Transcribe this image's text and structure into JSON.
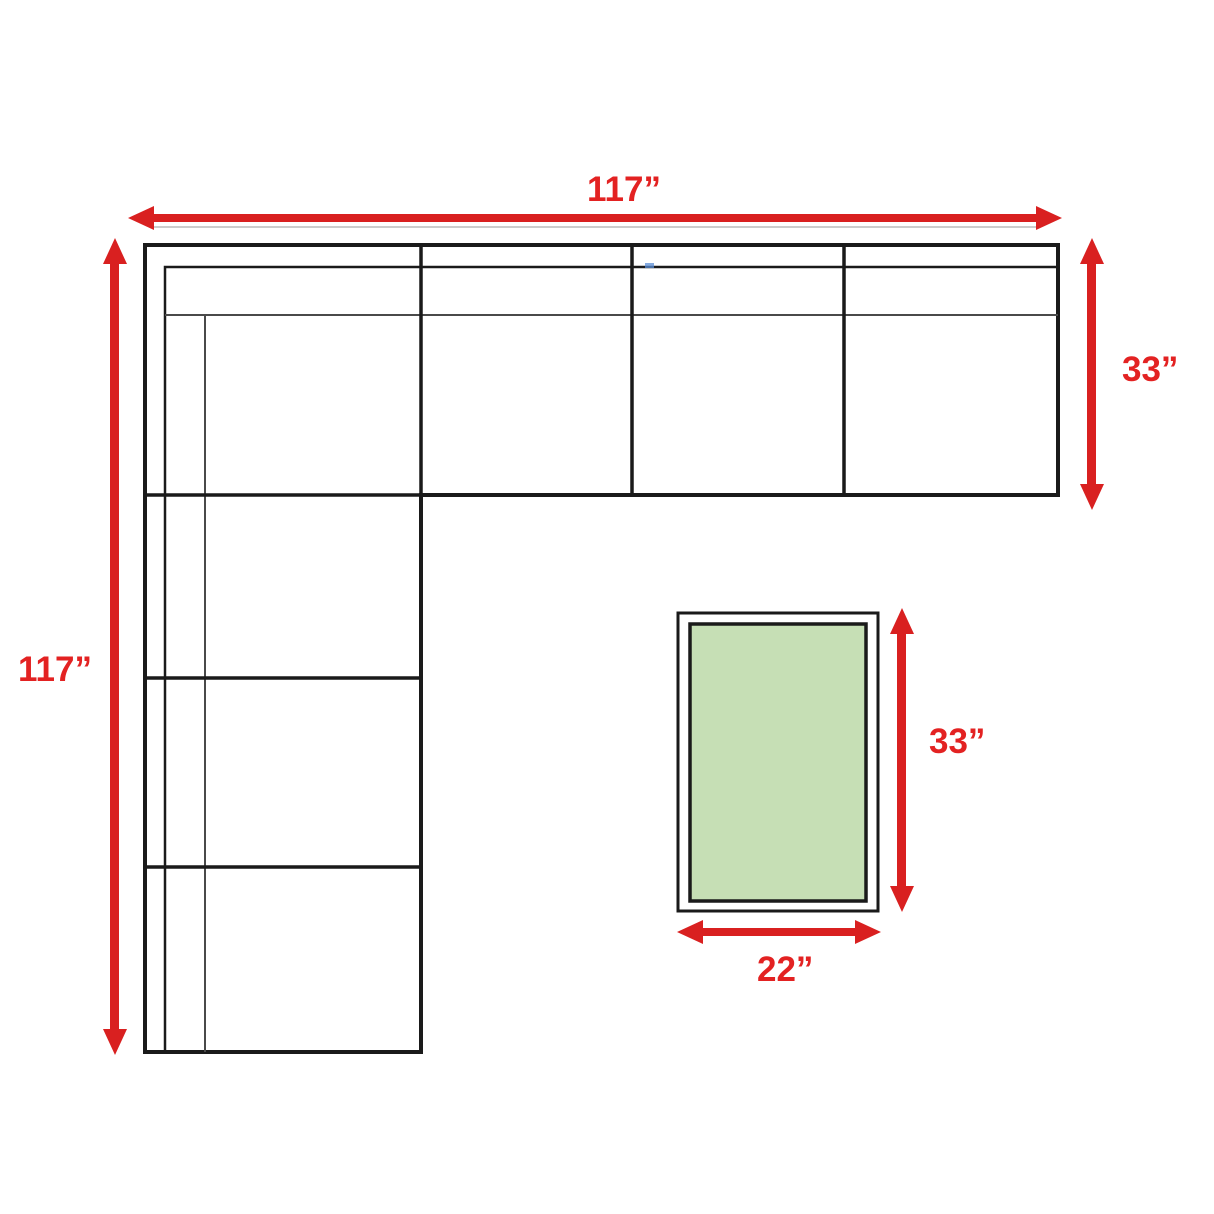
{
  "diagram": {
    "type": "furniture-dimension-diagram",
    "subject": "L-shaped sectional sofa floor plan with ottoman",
    "dimensions": {
      "sofa_top_width": "117”",
      "sofa_left_length": "117”",
      "sofa_section_depth": "33”",
      "ottoman_length": "33”",
      "ottoman_width": "22”"
    }
  },
  "colors": {
    "background": "#ffffff",
    "arrow_red": "#d92020",
    "label_red": "#e32222",
    "line_black": "#1a1a1a",
    "line_gray": "#4a4a4a",
    "ottoman_green": "#c6dfb5",
    "shadow_gray": "#cccccc",
    "artifact_blue": "#5b8dd6"
  }
}
